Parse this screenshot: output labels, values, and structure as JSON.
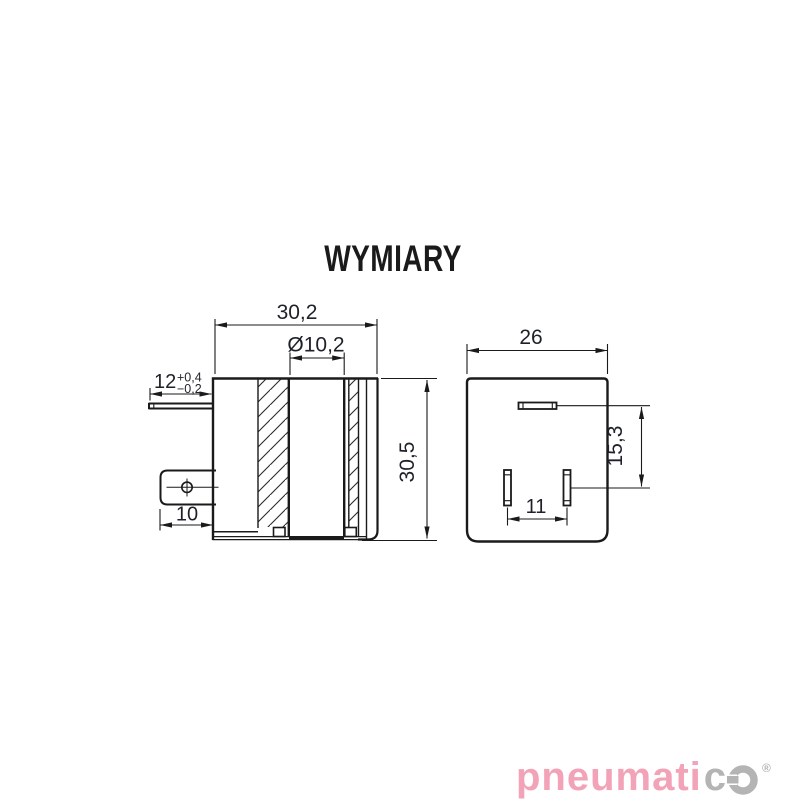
{
  "page": {
    "background": "#ffffff"
  },
  "title": "WYMIARY",
  "drawing": {
    "line_color": "#1a1a1a",
    "text_color": "#1e2129",
    "left_view": {
      "name": "coil side section view",
      "dim_width": "30,2",
      "dim_bore": "Ø10,2",
      "dim_pin": "12",
      "dim_pin_tol_plus": "+0,4",
      "dim_pin_tol_minus": "−0,2",
      "dim_tab": "10",
      "dim_height": "30,5"
    },
    "right_view": {
      "name": "connector bottom view",
      "dim_width": "26",
      "dim_pin_offset": "15,3",
      "dim_pin_spacing": "11"
    }
  },
  "logo": {
    "text_pink": "pneumati",
    "text_gray": "c",
    "registered": "®",
    "pink_color": "#f3a3b8",
    "gray_color": "#b4b4b4"
  }
}
